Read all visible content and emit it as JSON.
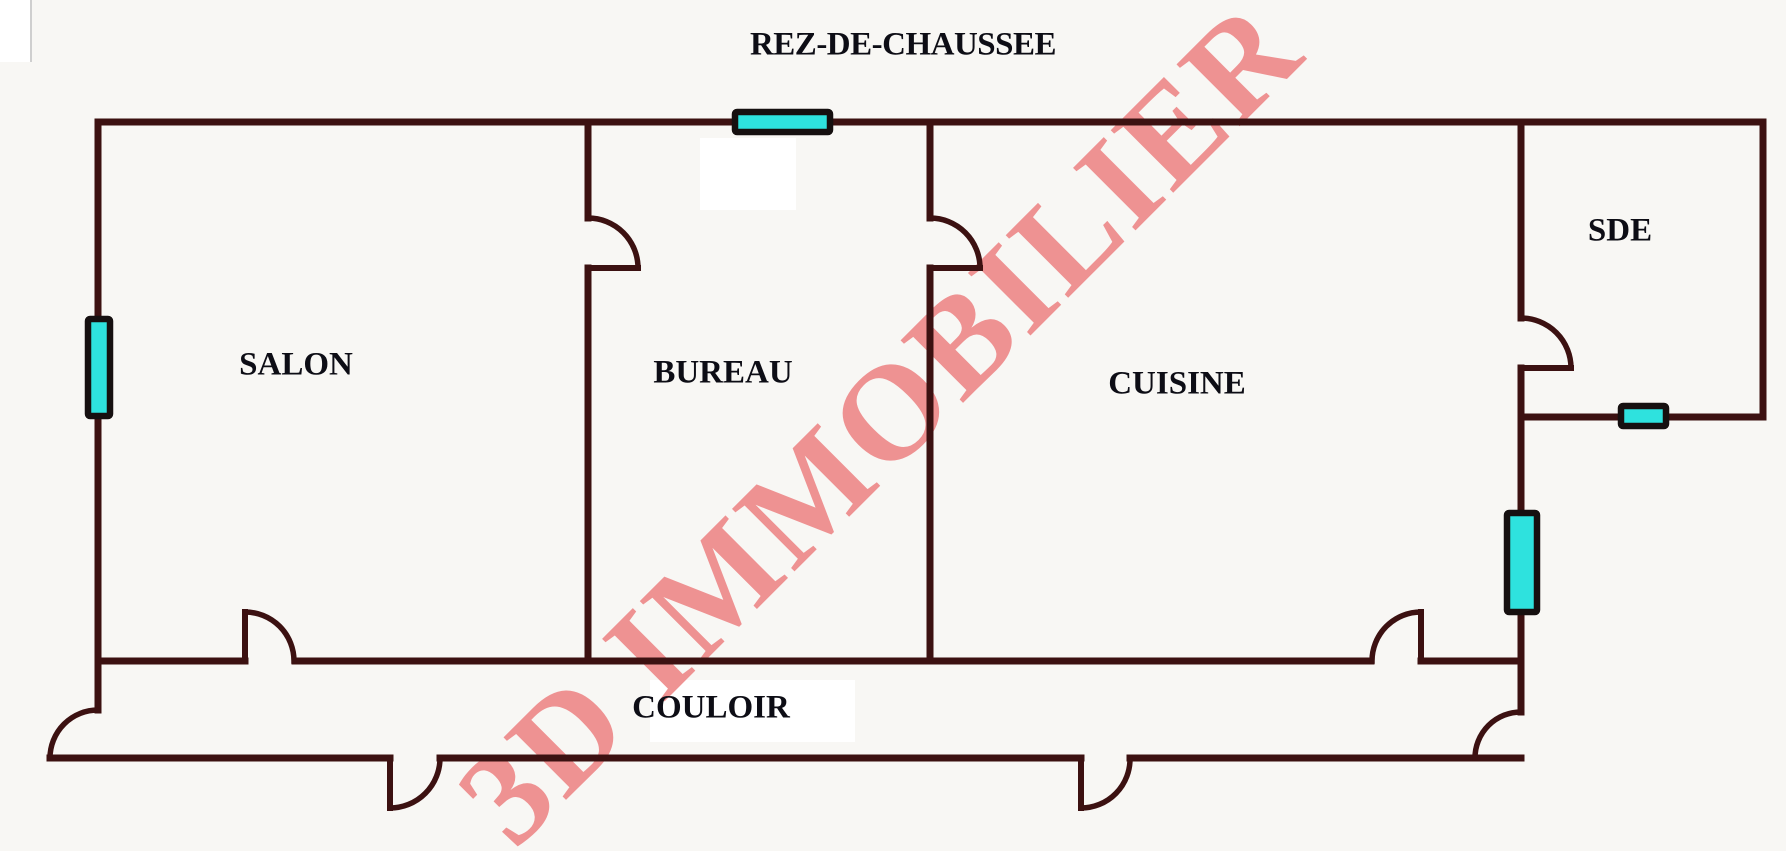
{
  "title": "REZ-DE-CHAUSSEE",
  "watermark": {
    "text": "3D IMMOBILIER",
    "color": "#ee8a8a"
  },
  "rooms": {
    "salon": {
      "label": "SALON"
    },
    "bureau": {
      "label": "BUREAU"
    },
    "cuisine": {
      "label": "CUISINE"
    },
    "sde": {
      "label": "SDE"
    },
    "couloir": {
      "label": "COULOIR"
    }
  },
  "colors": {
    "wall": "#3c1111",
    "window_fill": "#2ee2de",
    "window_border": "#161010",
    "background": "#f8f7f4",
    "label_text": "#0d0d15"
  }
}
